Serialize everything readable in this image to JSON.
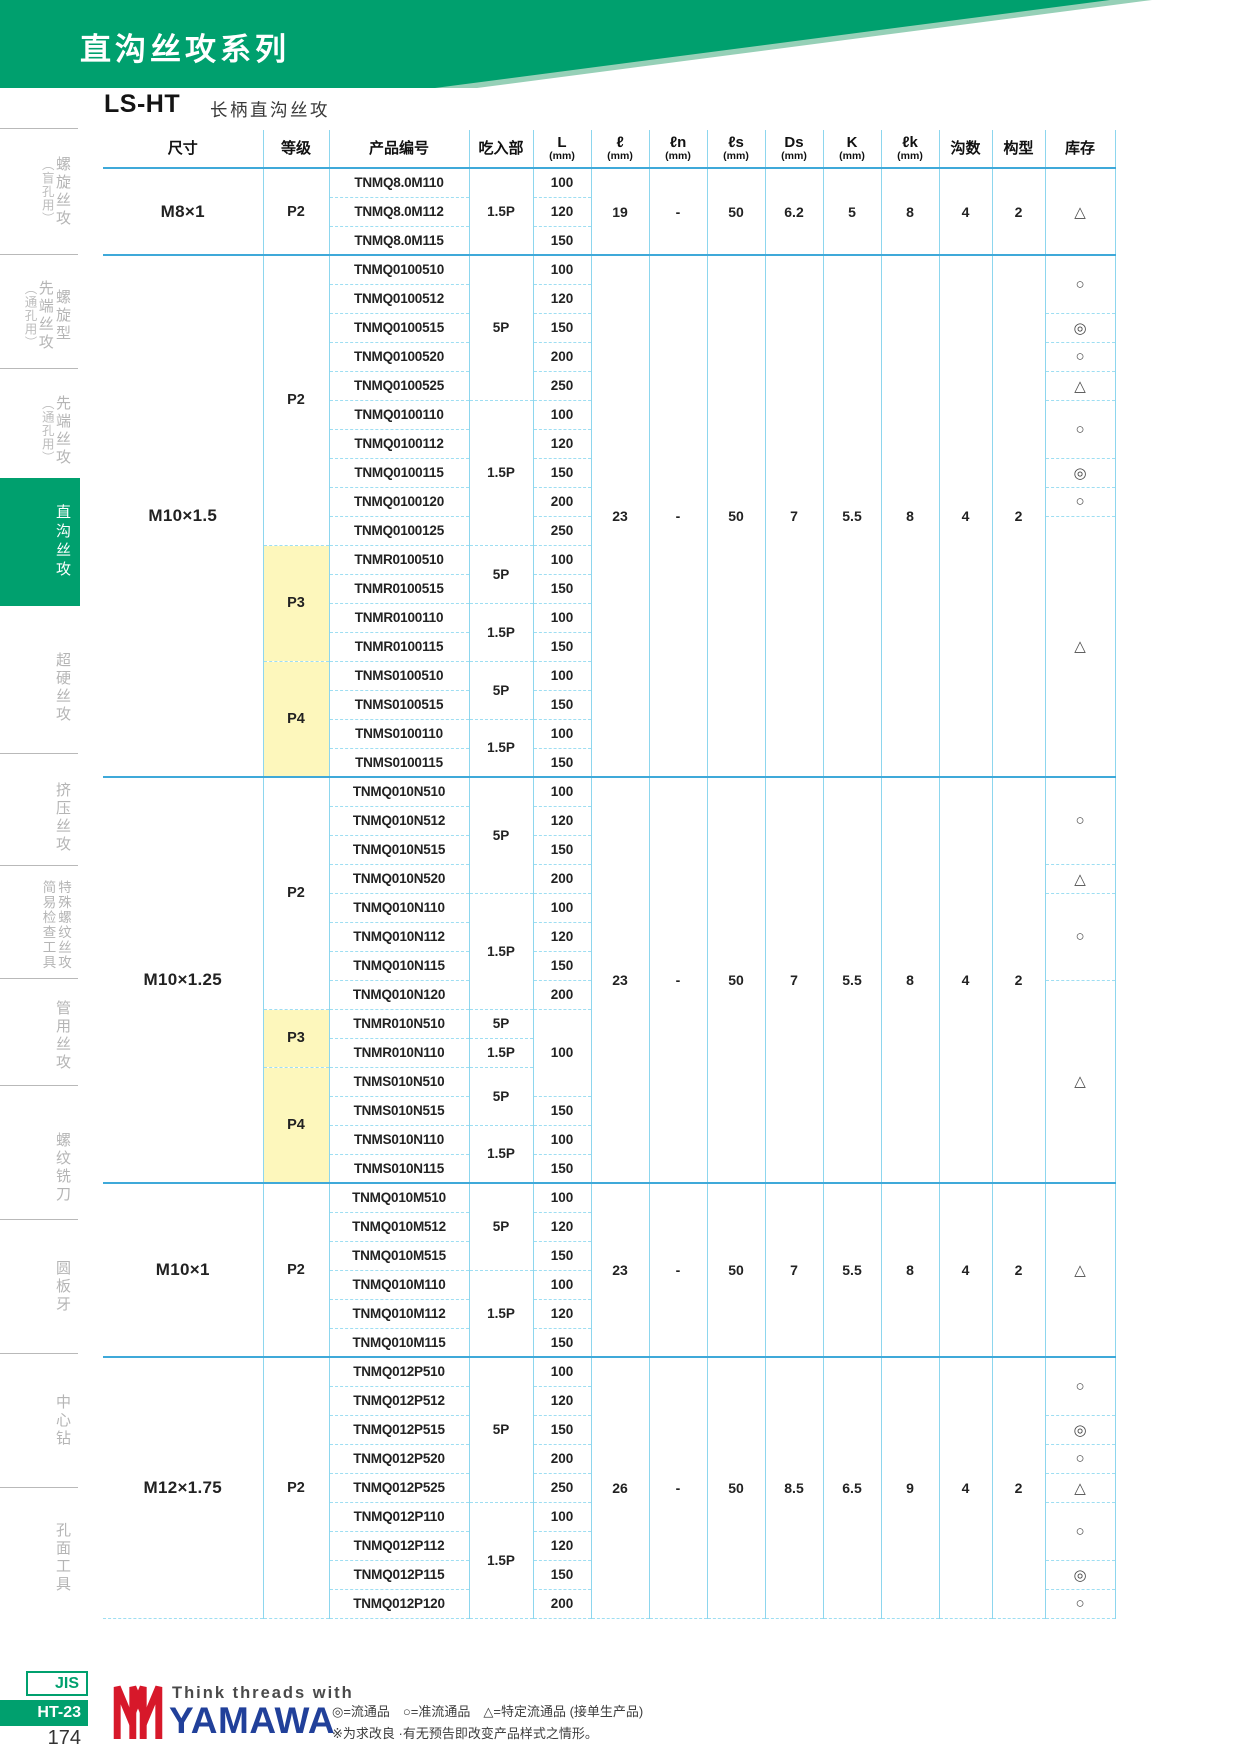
{
  "header": {
    "series_title": "直沟丝攻系列",
    "model": "LS-HT",
    "model_desc": "长柄直沟丝攻"
  },
  "colors": {
    "accent_green": "#00a06e",
    "accent_green_light": "#96d0b7",
    "table_line_blue": "#8dd6ee",
    "block_line_blue": "#3fa9d9",
    "grade_highlight_yellow": "#fdf7bc",
    "brand_blue": "#21409a",
    "brand_red": "#d7182a"
  },
  "sidebar": {
    "items": [
      {
        "id": "spiral-taps-blind",
        "lines": [
          "螺旋丝攻",
          "（盲孔用）"
        ],
        "active": false
      },
      {
        "id": "spiral-pointed-taps-through",
        "lines": [
          "螺旋型",
          "先端丝攻",
          "（通孔用）"
        ],
        "active": false
      },
      {
        "id": "pointed-taps-through",
        "lines": [
          "先端丝攻",
          "（通孔用）"
        ],
        "active": false
      },
      {
        "id": "straight-flute-taps",
        "lines": [
          "直沟丝攻"
        ],
        "active": true
      },
      {
        "id": "carbide-taps",
        "lines": [
          "超硬丝攻"
        ],
        "active": false
      },
      {
        "id": "forming-taps",
        "lines": [
          "挤压丝攻"
        ],
        "active": false
      },
      {
        "id": "special-thread-taps-gauges",
        "lines": [
          "特殊螺纹丝攻",
          "简易检查工具"
        ],
        "active": false
      },
      {
        "id": "pipe-taps",
        "lines": [
          "管用丝攻"
        ],
        "active": false
      },
      {
        "id": "thread-mills",
        "lines": [
          "螺纹铣刀"
        ],
        "active": false
      },
      {
        "id": "round-dies",
        "lines": [
          "圆板牙"
        ],
        "active": false
      },
      {
        "id": "center-drills",
        "lines": [
          "中心钻"
        ],
        "active": false
      },
      {
        "id": "hole-surface-tools",
        "lines": [
          "孔面工具"
        ],
        "active": false
      }
    ]
  },
  "table": {
    "columns": [
      {
        "label": "尺寸"
      },
      {
        "label": "等级"
      },
      {
        "label": "产品编号"
      },
      {
        "label": "吃入部"
      },
      {
        "label": "L",
        "unit": "(mm)"
      },
      {
        "label": "ℓ",
        "unit": "(mm)"
      },
      {
        "label": "ℓn",
        "unit": "(mm)"
      },
      {
        "label": "ℓs",
        "unit": "(mm)"
      },
      {
        "label": "Ds",
        "unit": "(mm)"
      },
      {
        "label": "K",
        "unit": "(mm)"
      },
      {
        "label": "ℓk",
        "unit": "(mm)"
      },
      {
        "label": "沟数"
      },
      {
        "label": "构型"
      },
      {
        "label": "库存"
      }
    ],
    "value_keys": [
      "l",
      "ln",
      "ls",
      "ds",
      "k",
      "lk",
      "flutes",
      "form"
    ],
    "blocks": [
      {
        "size": "M8×1",
        "values": [
          "19",
          "-",
          "50",
          "6.2",
          "5",
          "8",
          "4",
          "2"
        ],
        "grades": [
          {
            "grade": "P2",
            "yellow": false,
            "chamfers": [
              {
                "chamfer": "1.5P",
                "rows": [
                  [
                    "TNMQ8.0M110",
                    "100"
                  ],
                  [
                    "TNMQ8.0M112",
                    "120"
                  ],
                  [
                    "TNMQ8.0M115",
                    "150"
                  ]
                ]
              }
            ]
          }
        ],
        "stock": [
          [
            "△",
            3
          ]
        ]
      },
      {
        "size": "M10×1.5",
        "values": [
          "23",
          "-",
          "50",
          "7",
          "5.5",
          "8",
          "4",
          "2"
        ],
        "grades": [
          {
            "grade": "P2",
            "yellow": false,
            "chamfers": [
              {
                "chamfer": "5P",
                "rows": [
                  [
                    "TNMQ0100510",
                    "100"
                  ],
                  [
                    "TNMQ0100512",
                    "120"
                  ],
                  [
                    "TNMQ0100515",
                    "150"
                  ],
                  [
                    "TNMQ0100520",
                    "200"
                  ],
                  [
                    "TNMQ0100525",
                    "250"
                  ]
                ]
              },
              {
                "chamfer": "1.5P",
                "rows": [
                  [
                    "TNMQ0100110",
                    "100"
                  ],
                  [
                    "TNMQ0100112",
                    "120"
                  ],
                  [
                    "TNMQ0100115",
                    "150"
                  ],
                  [
                    "TNMQ0100120",
                    "200"
                  ],
                  [
                    "TNMQ0100125",
                    "250"
                  ]
                ]
              }
            ]
          },
          {
            "grade": "P3",
            "yellow": true,
            "chamfers": [
              {
                "chamfer": "5P",
                "rows": [
                  [
                    "TNMR0100510",
                    "100"
                  ],
                  [
                    "TNMR0100515",
                    "150"
                  ]
                ]
              },
              {
                "chamfer": "1.5P",
                "rows": [
                  [
                    "TNMR0100110",
                    "100"
                  ],
                  [
                    "TNMR0100115",
                    "150"
                  ]
                ]
              }
            ]
          },
          {
            "grade": "P4",
            "yellow": true,
            "chamfers": [
              {
                "chamfer": "5P",
                "rows": [
                  [
                    "TNMS0100510",
                    "100"
                  ],
                  [
                    "TNMS0100515",
                    "150"
                  ]
                ]
              },
              {
                "chamfer": "1.5P",
                "rows": [
                  [
                    "TNMS0100110",
                    "100"
                  ],
                  [
                    "TNMS0100115",
                    "150"
                  ]
                ]
              }
            ]
          }
        ],
        "stock": [
          [
            "○",
            2
          ],
          [
            "◎",
            1
          ],
          [
            "○",
            1
          ],
          [
            "△",
            1
          ],
          [
            "○",
            2
          ],
          [
            "◎",
            1
          ],
          [
            "○",
            1
          ],
          [
            "△",
            9
          ]
        ]
      },
      {
        "size": "M10×1.25",
        "values": [
          "23",
          "-",
          "50",
          "7",
          "5.5",
          "8",
          "4",
          "2"
        ],
        "grades": [
          {
            "grade": "P2",
            "yellow": false,
            "chamfers": [
              {
                "chamfer": "5P",
                "rows": [
                  [
                    "TNMQ010N510",
                    "100"
                  ],
                  [
                    "TNMQ010N512",
                    "120"
                  ],
                  [
                    "TNMQ010N515",
                    "150"
                  ],
                  [
                    "TNMQ010N520",
                    "200"
                  ]
                ]
              },
              {
                "chamfer": "1.5P",
                "rows": [
                  [
                    "TNMQ010N110",
                    "100"
                  ],
                  [
                    "TNMQ010N112",
                    "120"
                  ],
                  [
                    "TNMQ010N115",
                    "150"
                  ],
                  [
                    "TNMQ010N120",
                    "200"
                  ]
                ]
              }
            ]
          },
          {
            "grade": "P3",
            "yellow": true,
            "chamfers": [
              {
                "chamfer": "5P",
                "rows": [
                  [
                    "TNMR010N510",
                    "100",
                    3
                  ]
                ]
              },
              {
                "chamfer": "1.5P",
                "rows": [
                  [
                    "TNMR010N110",
                    null,
                    0
                  ]
                ]
              }
            ]
          },
          {
            "grade": "P4",
            "yellow": true,
            "chamfers": [
              {
                "chamfer": "5P",
                "rows": [
                  [
                    "TNMS010N510",
                    null,
                    0
                  ],
                  [
                    "TNMS010N515",
                    "150"
                  ]
                ]
              },
              {
                "chamfer": "1.5P",
                "rows": [
                  [
                    "TNMS010N110",
                    "100"
                  ],
                  [
                    "TNMS010N115",
                    "150"
                  ]
                ]
              }
            ]
          }
        ],
        "stock": [
          [
            "○",
            3
          ],
          [
            "△",
            1
          ],
          [
            "○",
            3
          ],
          [
            "△",
            7
          ]
        ]
      },
      {
        "size": "M10×1",
        "values": [
          "23",
          "-",
          "50",
          "7",
          "5.5",
          "8",
          "4",
          "2"
        ],
        "grades": [
          {
            "grade": "P2",
            "yellow": false,
            "chamfers": [
              {
                "chamfer": "5P",
                "rows": [
                  [
                    "TNMQ010M510",
                    "100"
                  ],
                  [
                    "TNMQ010M512",
                    "120"
                  ],
                  [
                    "TNMQ010M515",
                    "150"
                  ]
                ]
              },
              {
                "chamfer": "1.5P",
                "rows": [
                  [
                    "TNMQ010M110",
                    "100"
                  ],
                  [
                    "TNMQ010M112",
                    "120"
                  ],
                  [
                    "TNMQ010M115",
                    "150"
                  ]
                ]
              }
            ]
          }
        ],
        "stock": [
          [
            "△",
            6
          ]
        ]
      },
      {
        "size": "M12×1.75",
        "values": [
          "26",
          "-",
          "50",
          "8.5",
          "6.5",
          "9",
          "4",
          "2"
        ],
        "grades": [
          {
            "grade": "P2",
            "yellow": false,
            "chamfers": [
              {
                "chamfer": "5P",
                "rows": [
                  [
                    "TNMQ012P510",
                    "100"
                  ],
                  [
                    "TNMQ012P512",
                    "120"
                  ],
                  [
                    "TNMQ012P515",
                    "150"
                  ],
                  [
                    "TNMQ012P520",
                    "200"
                  ],
                  [
                    "TNMQ012P525",
                    "250"
                  ]
                ]
              },
              {
                "chamfer": "1.5P",
                "rows": [
                  [
                    "TNMQ012P110",
                    "100"
                  ],
                  [
                    "TNMQ012P112",
                    "120"
                  ],
                  [
                    "TNMQ012P115",
                    "150"
                  ],
                  [
                    "TNMQ012P120",
                    "200"
                  ]
                ]
              }
            ]
          }
        ],
        "stock": [
          [
            "○",
            2
          ],
          [
            "◎",
            1
          ],
          [
            "○",
            1
          ],
          [
            "△",
            1
          ],
          [
            "○",
            2
          ],
          [
            "◎",
            1
          ],
          [
            "○",
            1
          ]
        ]
      }
    ]
  },
  "footer": {
    "jis": "JIS",
    "code": "HT-23",
    "page": "174",
    "tagline": "Think threads with",
    "brand": "YAMAWA",
    "legend": "◎=流通品　○=准流通品　△=特定流通品 (接单生产品)",
    "note": "※为求改良 ·有无预告即改变产品样式之情形。"
  }
}
